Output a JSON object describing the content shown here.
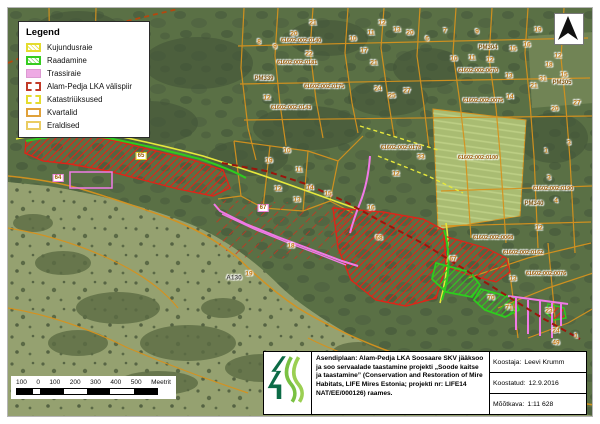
{
  "legend": {
    "title": "Legend",
    "items": [
      {
        "label": "Kujundusraie",
        "swatch": "yellow-hatch"
      },
      {
        "label": "Raadamine",
        "swatch": "green-hatch"
      },
      {
        "label": "Trassiraie",
        "swatch": "pink-fill"
      },
      {
        "label": "Alam-Pedja LKA välispiir",
        "swatch": "red-dash"
      },
      {
        "label": "Katastriüksused",
        "swatch": "yellow-dash"
      },
      {
        "label": "Kvartalid",
        "swatch": "orange-line"
      },
      {
        "label": "Eraldised",
        "swatch": "lightorange-line"
      }
    ]
  },
  "north_arrow": {
    "icon": "north-arrow"
  },
  "scalebar": {
    "labels": [
      "100",
      "0",
      "100",
      "200",
      "300",
      "400",
      "500"
    ],
    "unit": "Meetrit"
  },
  "info_box": {
    "description": "Asendiplaan: Alam-Pedja LKA Soosaare SKV jääksoo ja soo servaalade taastamine projekti „Soode kaitse ja taastamine” (Conservation and Restoration of Mire Habitats, LIFE Mires Estonia; projekti nr: LIFE14 NAT/EE/000126) raames.",
    "author_label": "Koostaja:",
    "author": "Leevi Krumm",
    "date_label": "Koostatud:",
    "date": "12.9.2016",
    "scale_label": "Mõõtkava:",
    "scale": "1:11 628"
  },
  "colors": {
    "kvartal_line": "#d6921e",
    "eraldis_line": "#e6e83c",
    "raadamine_green": "#2ecc1e",
    "kujundusraie_hatch": "#e0231a",
    "trassiraie_pink": "#f07ae6",
    "lka_border": "#9b150b",
    "forest": "#5a7045",
    "bog": "#95a170",
    "logo_green_dark": "#0c6b46",
    "logo_green_light": "#7ac143"
  },
  "map": {
    "labels": [
      {
        "t": "61602:002:0140",
        "x": 293,
        "y": 33,
        "k": "cad"
      },
      {
        "t": "61602:002:0181",
        "x": 289,
        "y": 55,
        "k": "cad"
      },
      {
        "t": "61602:002:0175",
        "x": 316,
        "y": 79,
        "k": "cad"
      },
      {
        "t": "61602:002:0143",
        "x": 283,
        "y": 100,
        "k": "cad"
      },
      {
        "t": "PM339",
        "x": 256,
        "y": 71,
        "k": "pm"
      },
      {
        "t": "PM304",
        "x": 480,
        "y": 40,
        "k": "pm"
      },
      {
        "t": "61602:002:0670",
        "x": 470,
        "y": 63,
        "k": "cad"
      },
      {
        "t": "61602:002:0075",
        "x": 475,
        "y": 93,
        "k": "cad"
      },
      {
        "t": "PM305",
        "x": 554,
        "y": 75,
        "k": "pm"
      },
      {
        "t": "61602:002:0100",
        "x": 470,
        "y": 150,
        "k": "cad"
      },
      {
        "t": "61602:002:0178",
        "x": 393,
        "y": 140,
        "k": "cad"
      },
      {
        "t": "61602:002:0190",
        "x": 545,
        "y": 181,
        "k": "cad"
      },
      {
        "t": "PM340",
        "x": 526,
        "y": 196,
        "k": "pm"
      },
      {
        "t": "61602:002:0068",
        "x": 485,
        "y": 230,
        "k": "cad"
      },
      {
        "t": "61602:002:0162",
        "x": 515,
        "y": 245,
        "k": "cad"
      },
      {
        "t": "61602:002:0076",
        "x": 538,
        "y": 266,
        "k": "cad"
      },
      {
        "t": "A130",
        "x": 226,
        "y": 270,
        "k": "dark"
      },
      {
        "t": "20",
        "x": 286,
        "y": 26,
        "k": "num"
      },
      {
        "t": "21",
        "x": 305,
        "y": 15,
        "k": "num"
      },
      {
        "t": "12",
        "x": 374,
        "y": 15,
        "k": "num"
      },
      {
        "t": "10",
        "x": 345,
        "y": 31,
        "k": "num"
      },
      {
        "t": "11",
        "x": 363,
        "y": 25,
        "k": "num"
      },
      {
        "t": "13",
        "x": 389,
        "y": 22,
        "k": "num"
      },
      {
        "t": "20",
        "x": 402,
        "y": 25,
        "k": "num"
      },
      {
        "t": "6",
        "x": 419,
        "y": 31,
        "k": "num"
      },
      {
        "t": "8",
        "x": 251,
        "y": 34,
        "k": "num"
      },
      {
        "t": "9",
        "x": 267,
        "y": 39,
        "k": "num"
      },
      {
        "t": "22",
        "x": 301,
        "y": 46,
        "k": "num"
      },
      {
        "t": "17",
        "x": 356,
        "y": 43,
        "k": "num"
      },
      {
        "t": "21",
        "x": 366,
        "y": 55,
        "k": "num"
      },
      {
        "t": "24",
        "x": 370,
        "y": 81,
        "k": "num"
      },
      {
        "t": "25",
        "x": 384,
        "y": 88,
        "k": "num"
      },
      {
        "t": "27",
        "x": 399,
        "y": 83,
        "k": "num"
      },
      {
        "t": "12",
        "x": 259,
        "y": 90,
        "k": "num"
      },
      {
        "t": "7",
        "x": 437,
        "y": 23,
        "k": "num"
      },
      {
        "t": "9",
        "x": 469,
        "y": 24,
        "k": "num"
      },
      {
        "t": "15",
        "x": 505,
        "y": 41,
        "k": "num"
      },
      {
        "t": "16",
        "x": 519,
        "y": 37,
        "k": "num"
      },
      {
        "t": "10",
        "x": 446,
        "y": 51,
        "k": "num"
      },
      {
        "t": "11",
        "x": 464,
        "y": 50,
        "k": "num"
      },
      {
        "t": "12",
        "x": 482,
        "y": 52,
        "k": "num"
      },
      {
        "t": "13",
        "x": 501,
        "y": 68,
        "k": "num"
      },
      {
        "t": "12",
        "x": 550,
        "y": 48,
        "k": "num"
      },
      {
        "t": "18",
        "x": 541,
        "y": 57,
        "k": "num"
      },
      {
        "t": "14",
        "x": 502,
        "y": 89,
        "k": "num"
      },
      {
        "t": "15",
        "x": 556,
        "y": 67,
        "k": "num"
      },
      {
        "t": "31",
        "x": 535,
        "y": 71,
        "k": "num"
      },
      {
        "t": "21",
        "x": 526,
        "y": 78,
        "k": "num"
      },
      {
        "t": "20",
        "x": 547,
        "y": 101,
        "k": "num"
      },
      {
        "t": "27",
        "x": 569,
        "y": 95,
        "k": "num"
      },
      {
        "t": "19",
        "x": 530,
        "y": 22,
        "k": "num"
      },
      {
        "t": "10",
        "x": 279,
        "y": 143,
        "k": "num"
      },
      {
        "t": "19",
        "x": 261,
        "y": 153,
        "k": "num"
      },
      {
        "t": "11",
        "x": 291,
        "y": 162,
        "k": "num"
      },
      {
        "t": "12",
        "x": 270,
        "y": 181,
        "k": "num"
      },
      {
        "t": "14",
        "x": 302,
        "y": 180,
        "k": "num"
      },
      {
        "t": "13",
        "x": 289,
        "y": 192,
        "k": "num"
      },
      {
        "t": "15",
        "x": 320,
        "y": 186,
        "k": "num"
      },
      {
        "t": "16",
        "x": 363,
        "y": 200,
        "k": "num"
      },
      {
        "t": "33",
        "x": 413,
        "y": 149,
        "k": "num"
      },
      {
        "t": "12",
        "x": 388,
        "y": 166,
        "k": "num"
      },
      {
        "t": "18",
        "x": 283,
        "y": 238,
        "k": "num"
      },
      {
        "t": "19",
        "x": 241,
        "y": 266,
        "k": "num"
      },
      {
        "t": "68",
        "x": 371,
        "y": 230,
        "k": "num"
      },
      {
        "t": "67",
        "x": 445,
        "y": 251,
        "k": "num"
      },
      {
        "t": "70",
        "x": 483,
        "y": 290,
        "k": "num"
      },
      {
        "t": "71",
        "x": 501,
        "y": 300,
        "k": "num"
      },
      {
        "t": "23",
        "x": 541,
        "y": 303,
        "k": "num"
      },
      {
        "t": "13",
        "x": 505,
        "y": 271,
        "k": "num"
      },
      {
        "t": "24",
        "x": 548,
        "y": 323,
        "k": "num"
      },
      {
        "t": "49",
        "x": 548,
        "y": 335,
        "k": "num"
      },
      {
        "t": "1",
        "x": 568,
        "y": 328,
        "k": "num"
      },
      {
        "t": "3",
        "x": 561,
        "y": 135,
        "k": "num"
      },
      {
        "t": "1",
        "x": 538,
        "y": 143,
        "k": "num"
      },
      {
        "t": "3",
        "x": 541,
        "y": 170,
        "k": "num"
      },
      {
        "t": "4",
        "x": 548,
        "y": 193,
        "k": "num"
      },
      {
        "t": "12",
        "x": 531,
        "y": 220,
        "k": "num"
      },
      {
        "t": "65",
        "x": 133,
        "y": 148,
        "k": "ybox"
      },
      {
        "t": "64",
        "x": 50,
        "y": 170,
        "k": "pbox"
      },
      {
        "t": "67",
        "x": 255,
        "y": 200,
        "k": "pbox"
      }
    ]
  }
}
